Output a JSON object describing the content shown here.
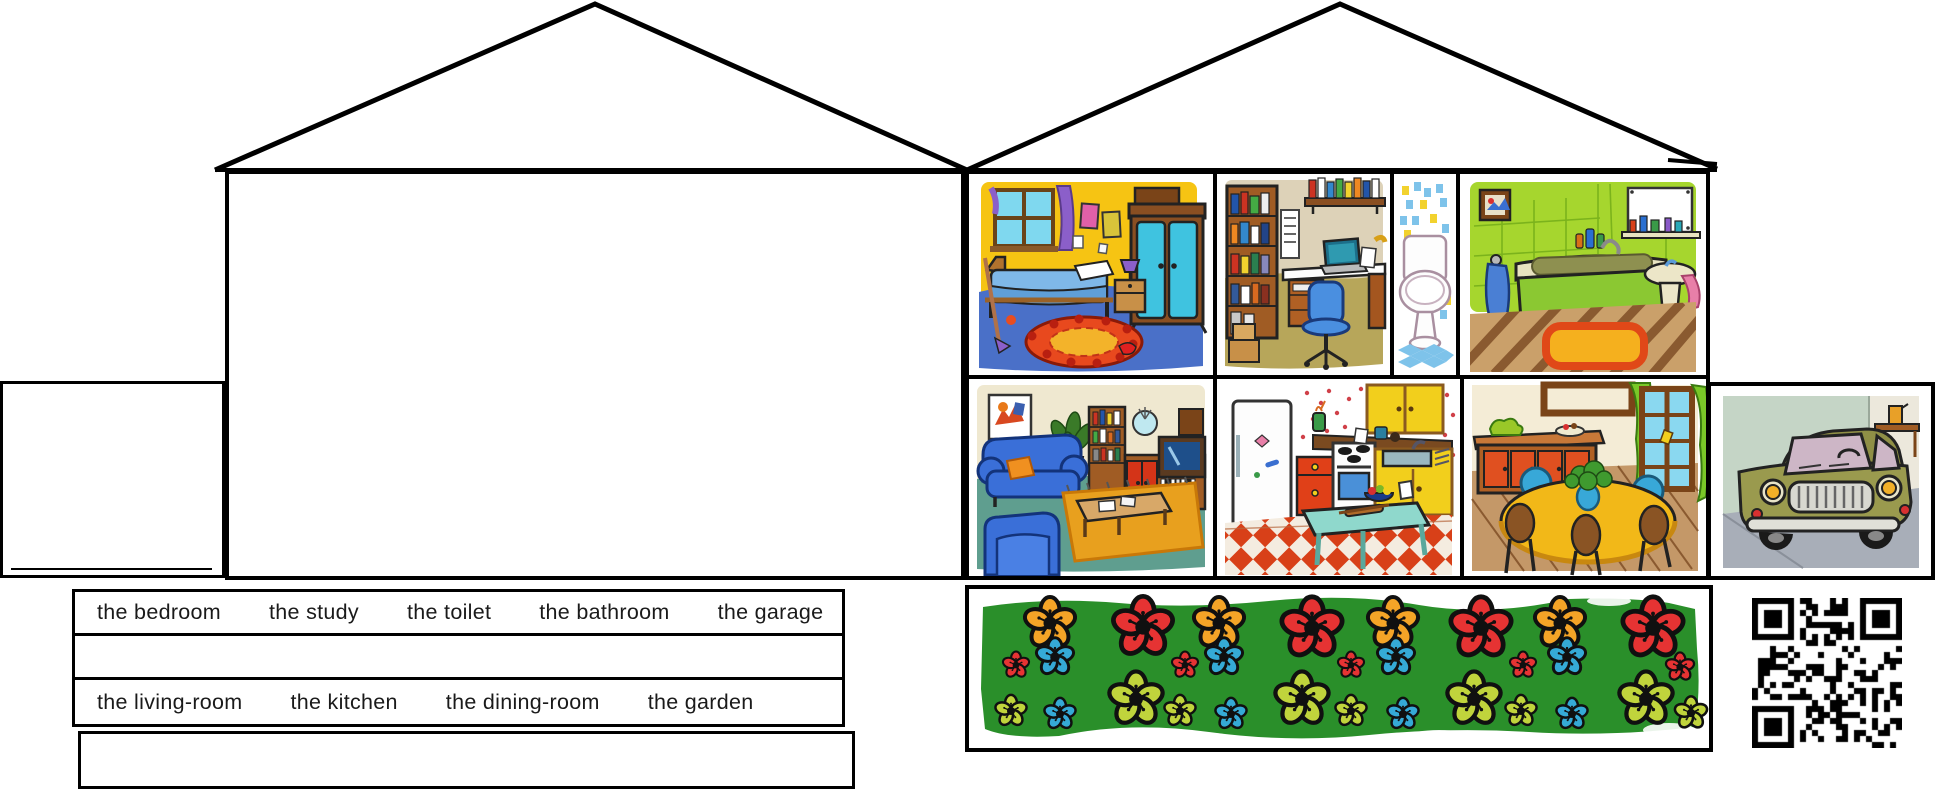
{
  "word_bank": {
    "row1": [
      "the bedroom",
      "the study",
      "the toilet",
      "the bathroom",
      "the garage"
    ],
    "row2": [
      "the living-room",
      "the kitchen",
      "the dining-room",
      "the garden"
    ]
  },
  "pictures": [
    "bedroom",
    "study",
    "toilet",
    "bathroom",
    "living-room",
    "kitchen",
    "dining-room",
    "garage",
    "garden"
  ],
  "garden": {
    "background": "#2a8f2a",
    "palette": {
      "o": "#f4a427",
      "r": "#e63333",
      "b": "#35aad6",
      "c": "#c0d43c"
    },
    "flowers": [
      [
        81,
        34,
        1.0,
        "o"
      ],
      [
        174,
        38,
        1.18,
        "r"
      ],
      [
        250,
        34,
        1.0,
        "o"
      ],
      [
        343,
        39,
        1.2,
        "r"
      ],
      [
        424,
        34,
        1.0,
        "o"
      ],
      [
        512,
        39,
        1.2,
        "r"
      ],
      [
        591,
        34,
        1.0,
        "o"
      ],
      [
        684,
        39,
        1.2,
        "r"
      ],
      [
        47,
        76,
        0.52,
        "r"
      ],
      [
        86,
        68,
        0.74,
        "b"
      ],
      [
        216,
        76,
        0.52,
        "r"
      ],
      [
        255,
        68,
        0.74,
        "b"
      ],
      [
        382,
        76,
        0.52,
        "r"
      ],
      [
        427,
        68,
        0.74,
        "b"
      ],
      [
        554,
        76,
        0.52,
        "r"
      ],
      [
        598,
        68,
        0.74,
        "b"
      ],
      [
        711,
        78,
        0.56,
        "r"
      ],
      [
        42,
        122,
        0.62,
        "c"
      ],
      [
        91,
        125,
        0.62,
        "b"
      ],
      [
        167,
        110,
        1.06,
        "c"
      ],
      [
        211,
        122,
        0.62,
        "c"
      ],
      [
        262,
        125,
        0.62,
        "b"
      ],
      [
        333,
        110,
        1.06,
        "c"
      ],
      [
        382,
        122,
        0.62,
        "c"
      ],
      [
        434,
        125,
        0.62,
        "b"
      ],
      [
        505,
        110,
        1.06,
        "c"
      ],
      [
        552,
        122,
        0.62,
        "c"
      ],
      [
        603,
        125,
        0.62,
        "b"
      ],
      [
        677,
        110,
        1.06,
        "c"
      ],
      [
        722,
        124,
        0.64,
        "c"
      ]
    ]
  },
  "qr": {
    "label": "qr-code",
    "modules": 25,
    "seed": 7
  }
}
